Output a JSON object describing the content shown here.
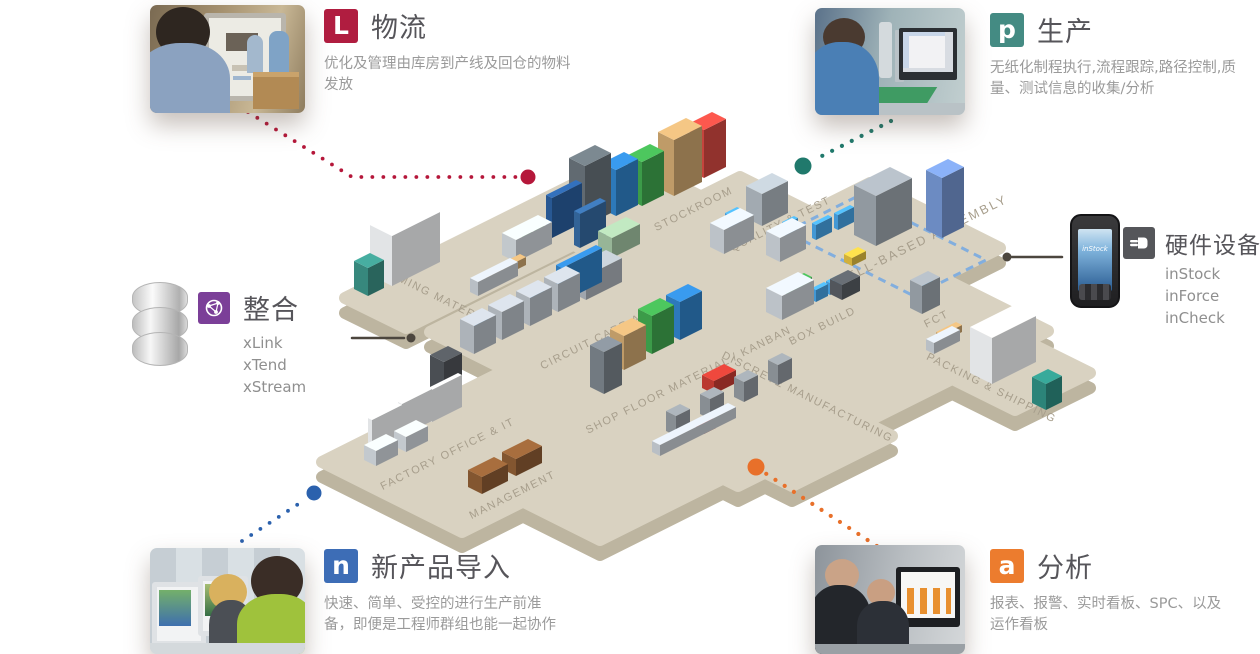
{
  "callouts": {
    "logistics": {
      "icon_letter": "L",
      "title": "物流",
      "description": "优化及管理由库房到产线及回仓的物料\n发放"
    },
    "production": {
      "icon_letter": "p",
      "title": "生产",
      "description": "无纸化制程执行,流程跟踪,路径控制,质\n量、测试信息的收集/分析"
    },
    "integration": {
      "title": "整合",
      "products": [
        "xLink",
        "xTend",
        "xStream"
      ]
    },
    "hardware": {
      "title": "硬件设备",
      "products": [
        "inStock",
        "inForce",
        "inCheck"
      ],
      "device_screen_label": "inStock"
    },
    "npi": {
      "icon_letter": "n",
      "title": "新产品导入",
      "description": "快速、简单、受控的进行生产前准\n备，即便是工程师群组也能一起协作"
    },
    "analytics": {
      "icon_letter": "a",
      "title": "分析",
      "description": "报表、报警、实时看板、SPC、以及\n运作看板"
    }
  },
  "floor_areas": [
    "STOCKROOM",
    "QUALITY & TEST",
    "CELL-BASED ASSEMBLY",
    "INCOMING MATERIAL",
    "CIRCUIT CARD ASSEMBLY",
    "BOX BUILD",
    "FCT",
    "SHOP FLOOR MATERIAL / KANBAN",
    "DISCRETE MANUFACTURING",
    "PACKING & SHIPPING",
    "FACTORY OFFICE & IT",
    "MANAGEMENT"
  ],
  "colors": {
    "logistics": "#b01d40",
    "production": "#448b83",
    "integration": "#7b3f98",
    "hardware": "#55565a",
    "npi": "#3d6db6",
    "analytics": "#ec7c2e",
    "floor": "#d9d2c1",
    "floor_edge": "#bdb5a0",
    "area_label": "#a79e8c"
  }
}
